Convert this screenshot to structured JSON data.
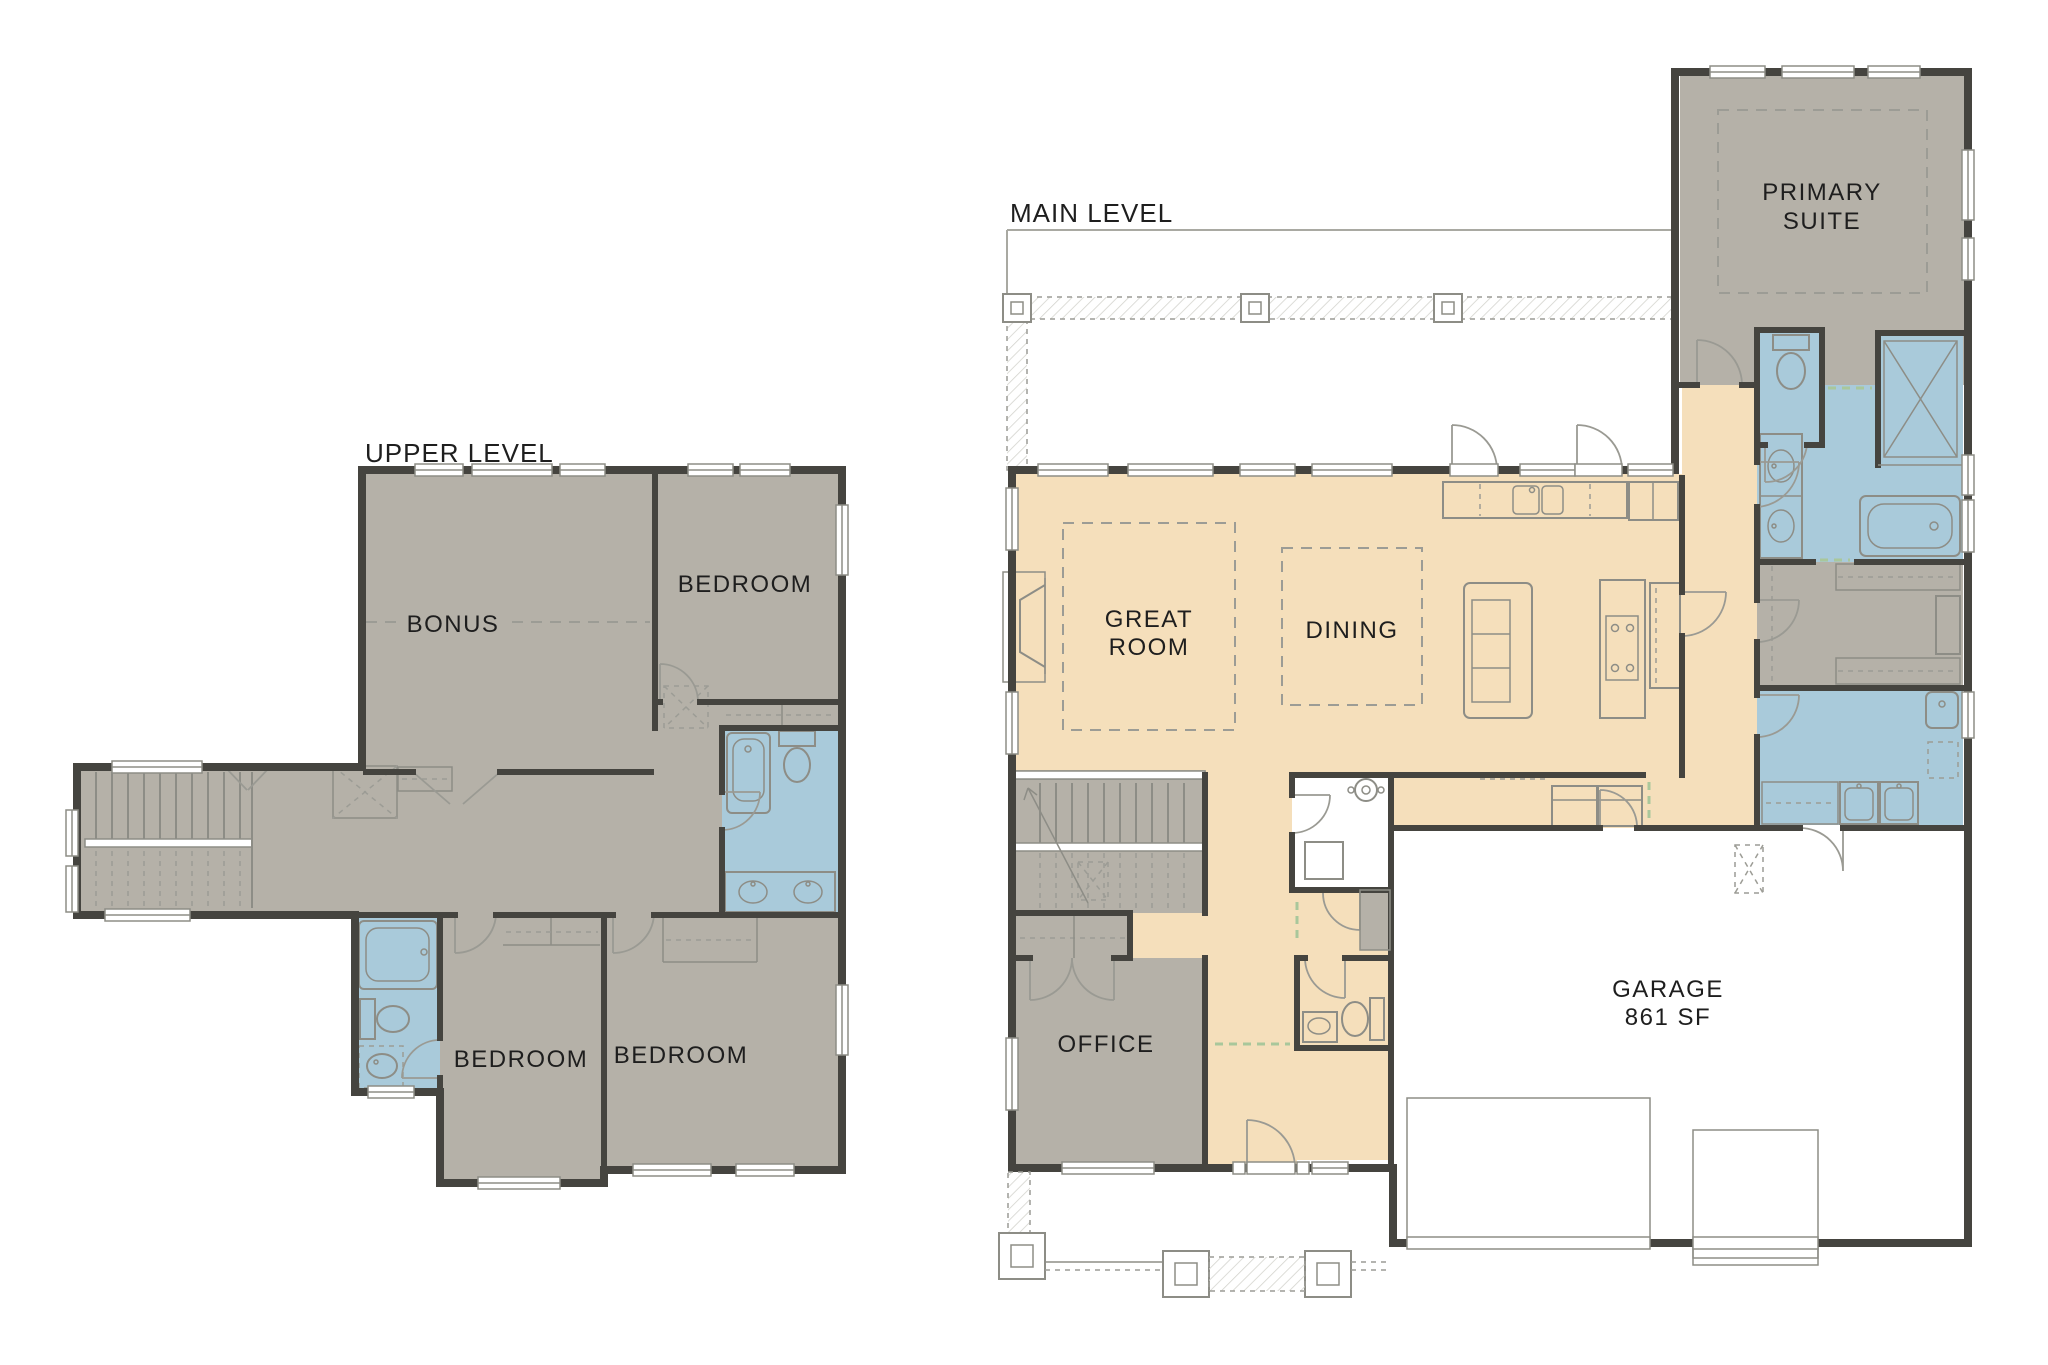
{
  "document": {
    "type": "residential floor plan, two levels",
    "background": "#ffffff"
  },
  "colors": {
    "room_gray": "#b5b1a8",
    "floor_tan": "#f5dfbb",
    "wet_blue": "#a9cada",
    "wall": "#45443f",
    "line": "#8d8d86",
    "dash": "#9c9c95",
    "opening": "#a9c79b",
    "label": "#1e1e1e",
    "deck_line": "#a9a9a2",
    "hatch": "#d4d4ce"
  },
  "upper_level": {
    "title": "UPPER LEVEL",
    "rooms": {
      "bonus": "BONUS",
      "bedroom_top_right": "BEDROOM",
      "bedroom_bottom_middle": "BEDROOM",
      "bedroom_bottom_right": "BEDROOM"
    }
  },
  "main_level": {
    "title": "MAIN LEVEL",
    "rooms": {
      "great_room_line1": "GREAT",
      "great_room_line2": "ROOM",
      "dining": "DINING",
      "office": "OFFICE",
      "primary_suite_line1": "PRIMARY",
      "primary_suite_line2": "SUITE",
      "garage_name": "GARAGE",
      "garage_area": "861 SF"
    }
  }
}
